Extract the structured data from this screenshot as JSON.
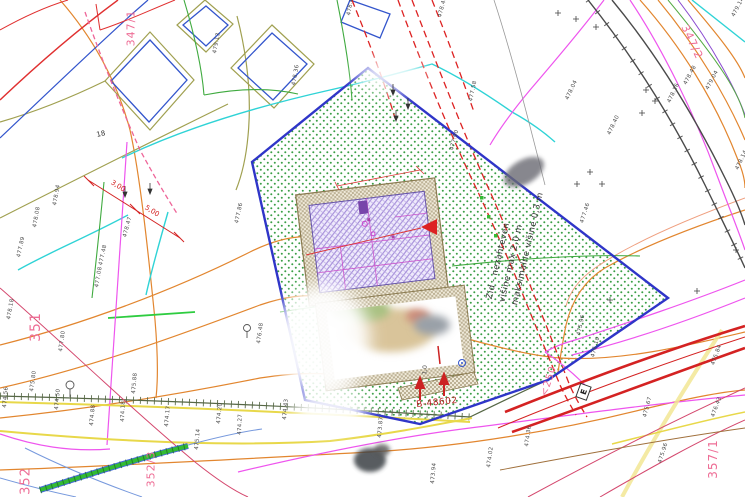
{
  "annotation_wall": {
    "line1": "Zid - nezahteven",
    "line2": "višine max 2,0 m",
    "line3": "maksimalne višine 0,3 m"
  },
  "parcel_labels": [
    {
      "text": "347/1"
    },
    {
      "text": "347/2"
    },
    {
      "text": "351"
    },
    {
      "text": "352"
    },
    {
      "text": "352/3"
    },
    {
      "text": "357/1"
    },
    {
      "text": "<250"
    }
  ],
  "point_label": "B-48602",
  "house_number": "18",
  "utility_box_label": "E",
  "dimensions": {
    "d1": "3,00",
    "d2": "5,00",
    "d3": "1,0"
  },
  "elevation_points": [
    {
      "x": 38,
      "y": 222,
      "r": -80,
      "t": "478.08"
    },
    {
      "x": 58,
      "y": 200,
      "r": -80,
      "t": "478.94"
    },
    {
      "x": 22,
      "y": 252,
      "r": -78,
      "t": "477.89"
    },
    {
      "x": 12,
      "y": 314,
      "r": -80,
      "t": "478.18"
    },
    {
      "x": 64,
      "y": 346,
      "r": -82,
      "t": "477.80"
    },
    {
      "x": 100,
      "y": 282,
      "r": -80,
      "t": "477.08"
    },
    {
      "x": 128,
      "y": 232,
      "r": -75,
      "t": "478.47"
    },
    {
      "x": 104,
      "y": 260,
      "r": -78,
      "t": "477.48"
    },
    {
      "x": 137,
      "y": 388,
      "r": -85,
      "t": "475.88"
    },
    {
      "x": 35,
      "y": 386,
      "r": -82,
      "t": "475.80"
    },
    {
      "x": 95,
      "y": 420,
      "r": -85,
      "t": "474.88"
    },
    {
      "x": 126,
      "y": 416,
      "r": -88,
      "t": "474.18"
    },
    {
      "x": 170,
      "y": 421,
      "r": -85,
      "t": "474.17"
    },
    {
      "x": 222,
      "y": 418,
      "r": -85,
      "t": "474.20"
    },
    {
      "x": 243,
      "y": 429,
      "r": -88,
      "t": "474.27"
    },
    {
      "x": 288,
      "y": 414,
      "r": -85,
      "t": "474.43"
    },
    {
      "x": 200,
      "y": 444,
      "r": -85,
      "t": "475.14"
    },
    {
      "x": 383,
      "y": 432,
      "r": -85,
      "t": "473.87"
    },
    {
      "x": 436,
      "y": 478,
      "r": -85,
      "t": "473.94"
    },
    {
      "x": 492,
      "y": 462,
      "r": -82,
      "t": "474.02"
    },
    {
      "x": 530,
      "y": 441,
      "r": -82,
      "t": "474.36"
    },
    {
      "x": 582,
      "y": 330,
      "r": -78,
      "t": "475.96"
    },
    {
      "x": 596,
      "y": 352,
      "r": -75,
      "t": "476.10"
    },
    {
      "x": 648,
      "y": 412,
      "r": -75,
      "t": "475.67"
    },
    {
      "x": 663,
      "y": 458,
      "r": -72,
      "t": "475.96"
    },
    {
      "x": 716,
      "y": 412,
      "r": -70,
      "t": "476.43"
    },
    {
      "x": 672,
      "y": 98,
      "r": -65,
      "t": "478.16"
    },
    {
      "x": 710,
      "y": 85,
      "r": -62,
      "t": "479.04"
    },
    {
      "x": 688,
      "y": 80,
      "r": -62,
      "t": "478.48"
    },
    {
      "x": 612,
      "y": 130,
      "r": -65,
      "t": "478.40"
    },
    {
      "x": 570,
      "y": 95,
      "r": -65,
      "t": "478.04"
    },
    {
      "x": 352,
      "y": 10,
      "r": -80,
      "t": "478.46"
    },
    {
      "x": 443,
      "y": 12,
      "r": -75,
      "t": "478.40"
    },
    {
      "x": 474,
      "y": 96,
      "r": -78,
      "t": "477.58"
    },
    {
      "x": 297,
      "y": 80,
      "r": -80,
      "t": "478.36"
    },
    {
      "x": 218,
      "y": 48,
      "r": -80,
      "t": "479.13"
    },
    {
      "x": 240,
      "y": 218,
      "r": -78,
      "t": "477.86"
    },
    {
      "x": 262,
      "y": 338,
      "r": -82,
      "t": "476.48"
    },
    {
      "x": 585,
      "y": 218,
      "r": -72,
      "t": "477.46"
    },
    {
      "x": 455,
      "y": 145,
      "r": -75,
      "t": "477.90"
    },
    {
      "x": 736,
      "y": 12,
      "r": -62,
      "t": "479.14"
    },
    {
      "x": 740,
      "y": 165,
      "r": -65,
      "t": "478.14"
    },
    {
      "x": 716,
      "y": 360,
      "r": -70,
      "t": "475.84"
    },
    {
      "x": 8,
      "y": 402,
      "r": -85,
      "t": "474.56"
    },
    {
      "x": 60,
      "y": 404,
      "r": -85,
      "t": "474.50"
    }
  ],
  "colors": {
    "site_boundary_blue": "#2f35c8",
    "parcel_dot_green": "#3a9e46",
    "building_hatch_purple": "#9f86d8",
    "building_border_tan": "#c9bfa6",
    "contour_orange": "#e2862f",
    "road_yellow": "#e8d84a",
    "road_red": "#d42222",
    "utility_cyan": "#2fd3d6",
    "utility_magenta": "#ee55ee",
    "power_red_dashed": "#dd2222",
    "parcel_number_pink": "#ee6e96",
    "dimension_red": "#d42222",
    "annotation_gray": "#333333"
  }
}
